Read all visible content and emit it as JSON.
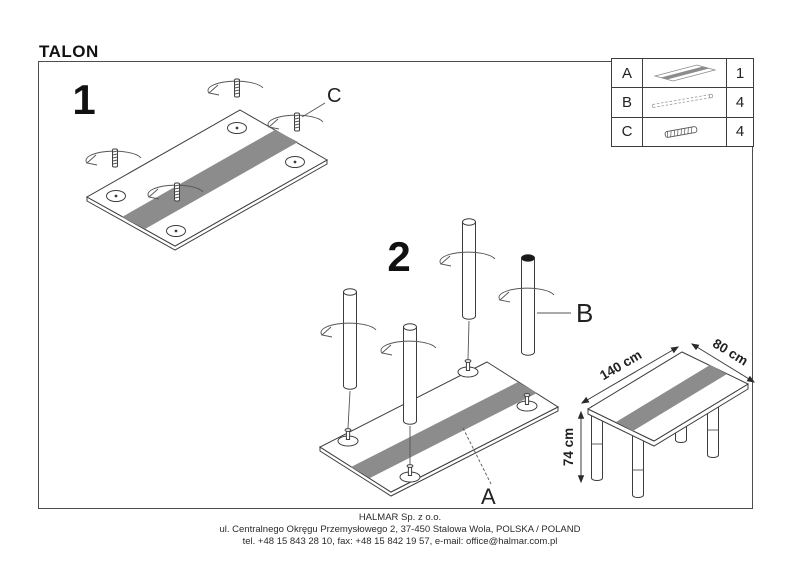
{
  "title": "TALON",
  "steps": {
    "step1": {
      "number": "1",
      "screw_label": "C"
    },
    "step2": {
      "number": "2",
      "leg_label": "B",
      "tabletop_label": "A"
    }
  },
  "parts_table": {
    "rows": [
      {
        "letter": "A",
        "icon": "tabletop-icon",
        "qty": "1"
      },
      {
        "letter": "B",
        "icon": "leg-icon",
        "qty": "4"
      },
      {
        "letter": "C",
        "icon": "screw-icon",
        "qty": "4"
      }
    ]
  },
  "dimensions": {
    "length": "140 cm",
    "depth": "80 cm",
    "height": "74 cm"
  },
  "footer": {
    "company": "HALMAR Sp. z o.o.",
    "address": "ul. Centralnego Okręgu Przemysłowego 2, 37-450 Stalowa Wola, POLSKA / POLAND",
    "contact": "tel. +48 15 843 28 10, fax: +48 15 842 19 57, e-mail: office@halmar.com.pl"
  },
  "colors": {
    "stripe": "#8c8c8c",
    "line": "#3d3d3d",
    "frame": "#4d4d4d"
  }
}
